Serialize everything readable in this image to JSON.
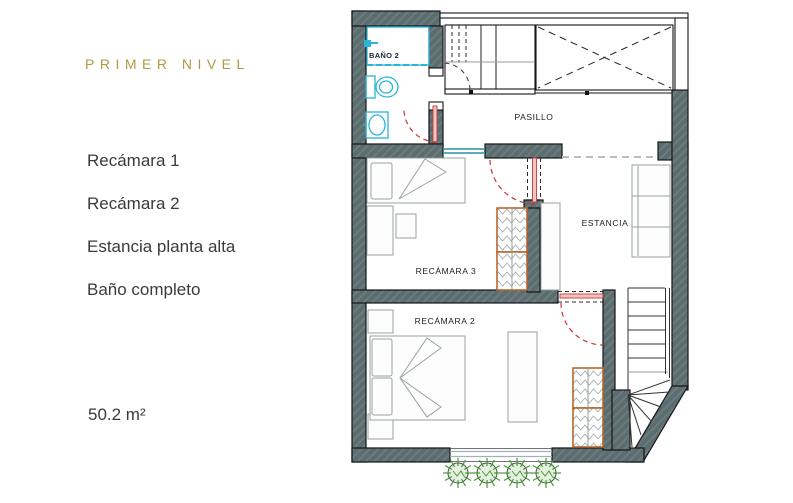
{
  "sidebar": {
    "title": "PRIMER NIVEL",
    "items": [
      "Recámara 1",
      "Recámara 2",
      "Estancia planta alta",
      "Baño completo"
    ],
    "area": "50.2 m²"
  },
  "plan": {
    "rooms": {
      "bathroom": "BAÑO 2",
      "hallway": "PASILLO",
      "bedroom3": "RECÁMARA 3",
      "living": "ESTANCIA",
      "bedroom2": "RECÁMARA 2"
    },
    "colors": {
      "accent_gold": "#b49843",
      "wall_fill": "#5c6d70",
      "closet_outline": "#b5672f",
      "door_swing_red": "#cc3333",
      "plumbing_cyan": "#2ab5d8",
      "window_teal": "#2f8fa3",
      "plant_green": "#3f9f2f"
    }
  }
}
